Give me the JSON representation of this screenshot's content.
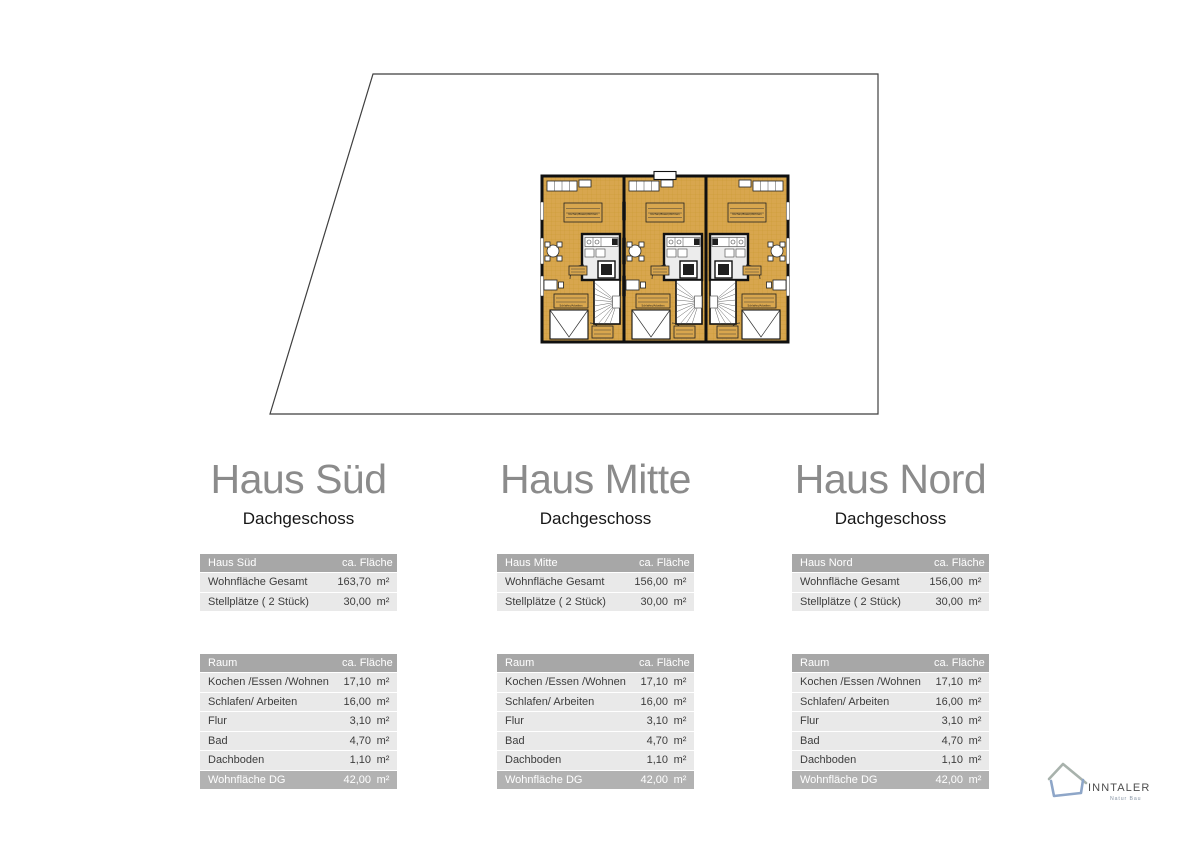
{
  "floor_plan": {
    "room_labels": [
      "Kochen/Essen/Wohnen",
      "Schlafen/Arbeiten",
      "Flur",
      "Bad",
      "Dachboden"
    ]
  },
  "columns": [
    {
      "title": "Haus Süd",
      "subtitle": "Dachgeschoss",
      "summary": {
        "title": "Haus Süd",
        "area_header": "ca. Fläche",
        "rows": [
          {
            "label": "Wohnfläche Gesamt",
            "value": "163,70",
            "unit": "m²"
          },
          {
            "label": "Stellplätze ( 2 Stück)",
            "value": "30,00",
            "unit": "m²"
          }
        ]
      },
      "rooms": {
        "title": "Raum",
        "area_header": "ca. Fläche",
        "rows": [
          {
            "label": "Kochen /Essen /Wohnen",
            "value": "17,10",
            "unit": "m²"
          },
          {
            "label": "Schlafen/ Arbeiten",
            "value": "16,00",
            "unit": "m²"
          },
          {
            "label": "Flur",
            "value": "3,10",
            "unit": "m²"
          },
          {
            "label": "Bad",
            "value": "4,70",
            "unit": "m²"
          },
          {
            "label": "Dachboden",
            "value": "1,10",
            "unit": "m²"
          }
        ],
        "footer": {
          "label": "Wohnfläche DG",
          "value": "42,00",
          "unit": "m²"
        }
      }
    },
    {
      "title": "Haus Mitte",
      "subtitle": "Dachgeschoss",
      "summary": {
        "title": "Haus Mitte",
        "area_header": "ca. Fläche",
        "rows": [
          {
            "label": "Wohnfläche Gesamt",
            "value": "156,00",
            "unit": "m²"
          },
          {
            "label": "Stellplätze ( 2 Stück)",
            "value": "30,00",
            "unit": "m²"
          }
        ]
      },
      "rooms": {
        "title": "Raum",
        "area_header": "ca. Fläche",
        "rows": [
          {
            "label": "Kochen /Essen /Wohnen",
            "value": "17,10",
            "unit": "m²"
          },
          {
            "label": "Schlafen/ Arbeiten",
            "value": "16,00",
            "unit": "m²"
          },
          {
            "label": "Flur",
            "value": "3,10",
            "unit": "m²"
          },
          {
            "label": "Bad",
            "value": "4,70",
            "unit": "m²"
          },
          {
            "label": "Dachboden",
            "value": "1,10",
            "unit": "m²"
          }
        ],
        "footer": {
          "label": "Wohnfläche DG",
          "value": "42,00",
          "unit": "m²"
        }
      }
    },
    {
      "title": "Haus Nord",
      "subtitle": "Dachgeschoss",
      "summary": {
        "title": "Haus Nord",
        "area_header": "ca. Fläche",
        "rows": [
          {
            "label": "Wohnfläche Gesamt",
            "value": "156,00",
            "unit": "m²"
          },
          {
            "label": "Stellplätze ( 2 Stück)",
            "value": "30,00",
            "unit": "m²"
          }
        ]
      },
      "rooms": {
        "title": "Raum",
        "area_header": "ca. Fläche",
        "rows": [
          {
            "label": "Kochen /Essen /Wohnen",
            "value": "17,10",
            "unit": "m²"
          },
          {
            "label": "Schlafen/ Arbeiten",
            "value": "16,00",
            "unit": "m²"
          },
          {
            "label": "Flur",
            "value": "3,10",
            "unit": "m²"
          },
          {
            "label": "Bad",
            "value": "4,70",
            "unit": "m²"
          },
          {
            "label": "Dachboden",
            "value": "1,10",
            "unit": "m²"
          }
        ],
        "footer": {
          "label": "Wohnfläche DG",
          "value": "42,00",
          "unit": "m²"
        }
      }
    }
  ],
  "logo": {
    "brand": "INNTALER",
    "tagline": "Natur Bau"
  },
  "colors": {
    "table_header": "#a7a7a7",
    "table_row": "#e9e9e9",
    "table_footer": "#b2b2b2",
    "floor": "#d8a64e",
    "logo_roof": "#a8b2ac",
    "logo_base": "#8ea6c8"
  }
}
